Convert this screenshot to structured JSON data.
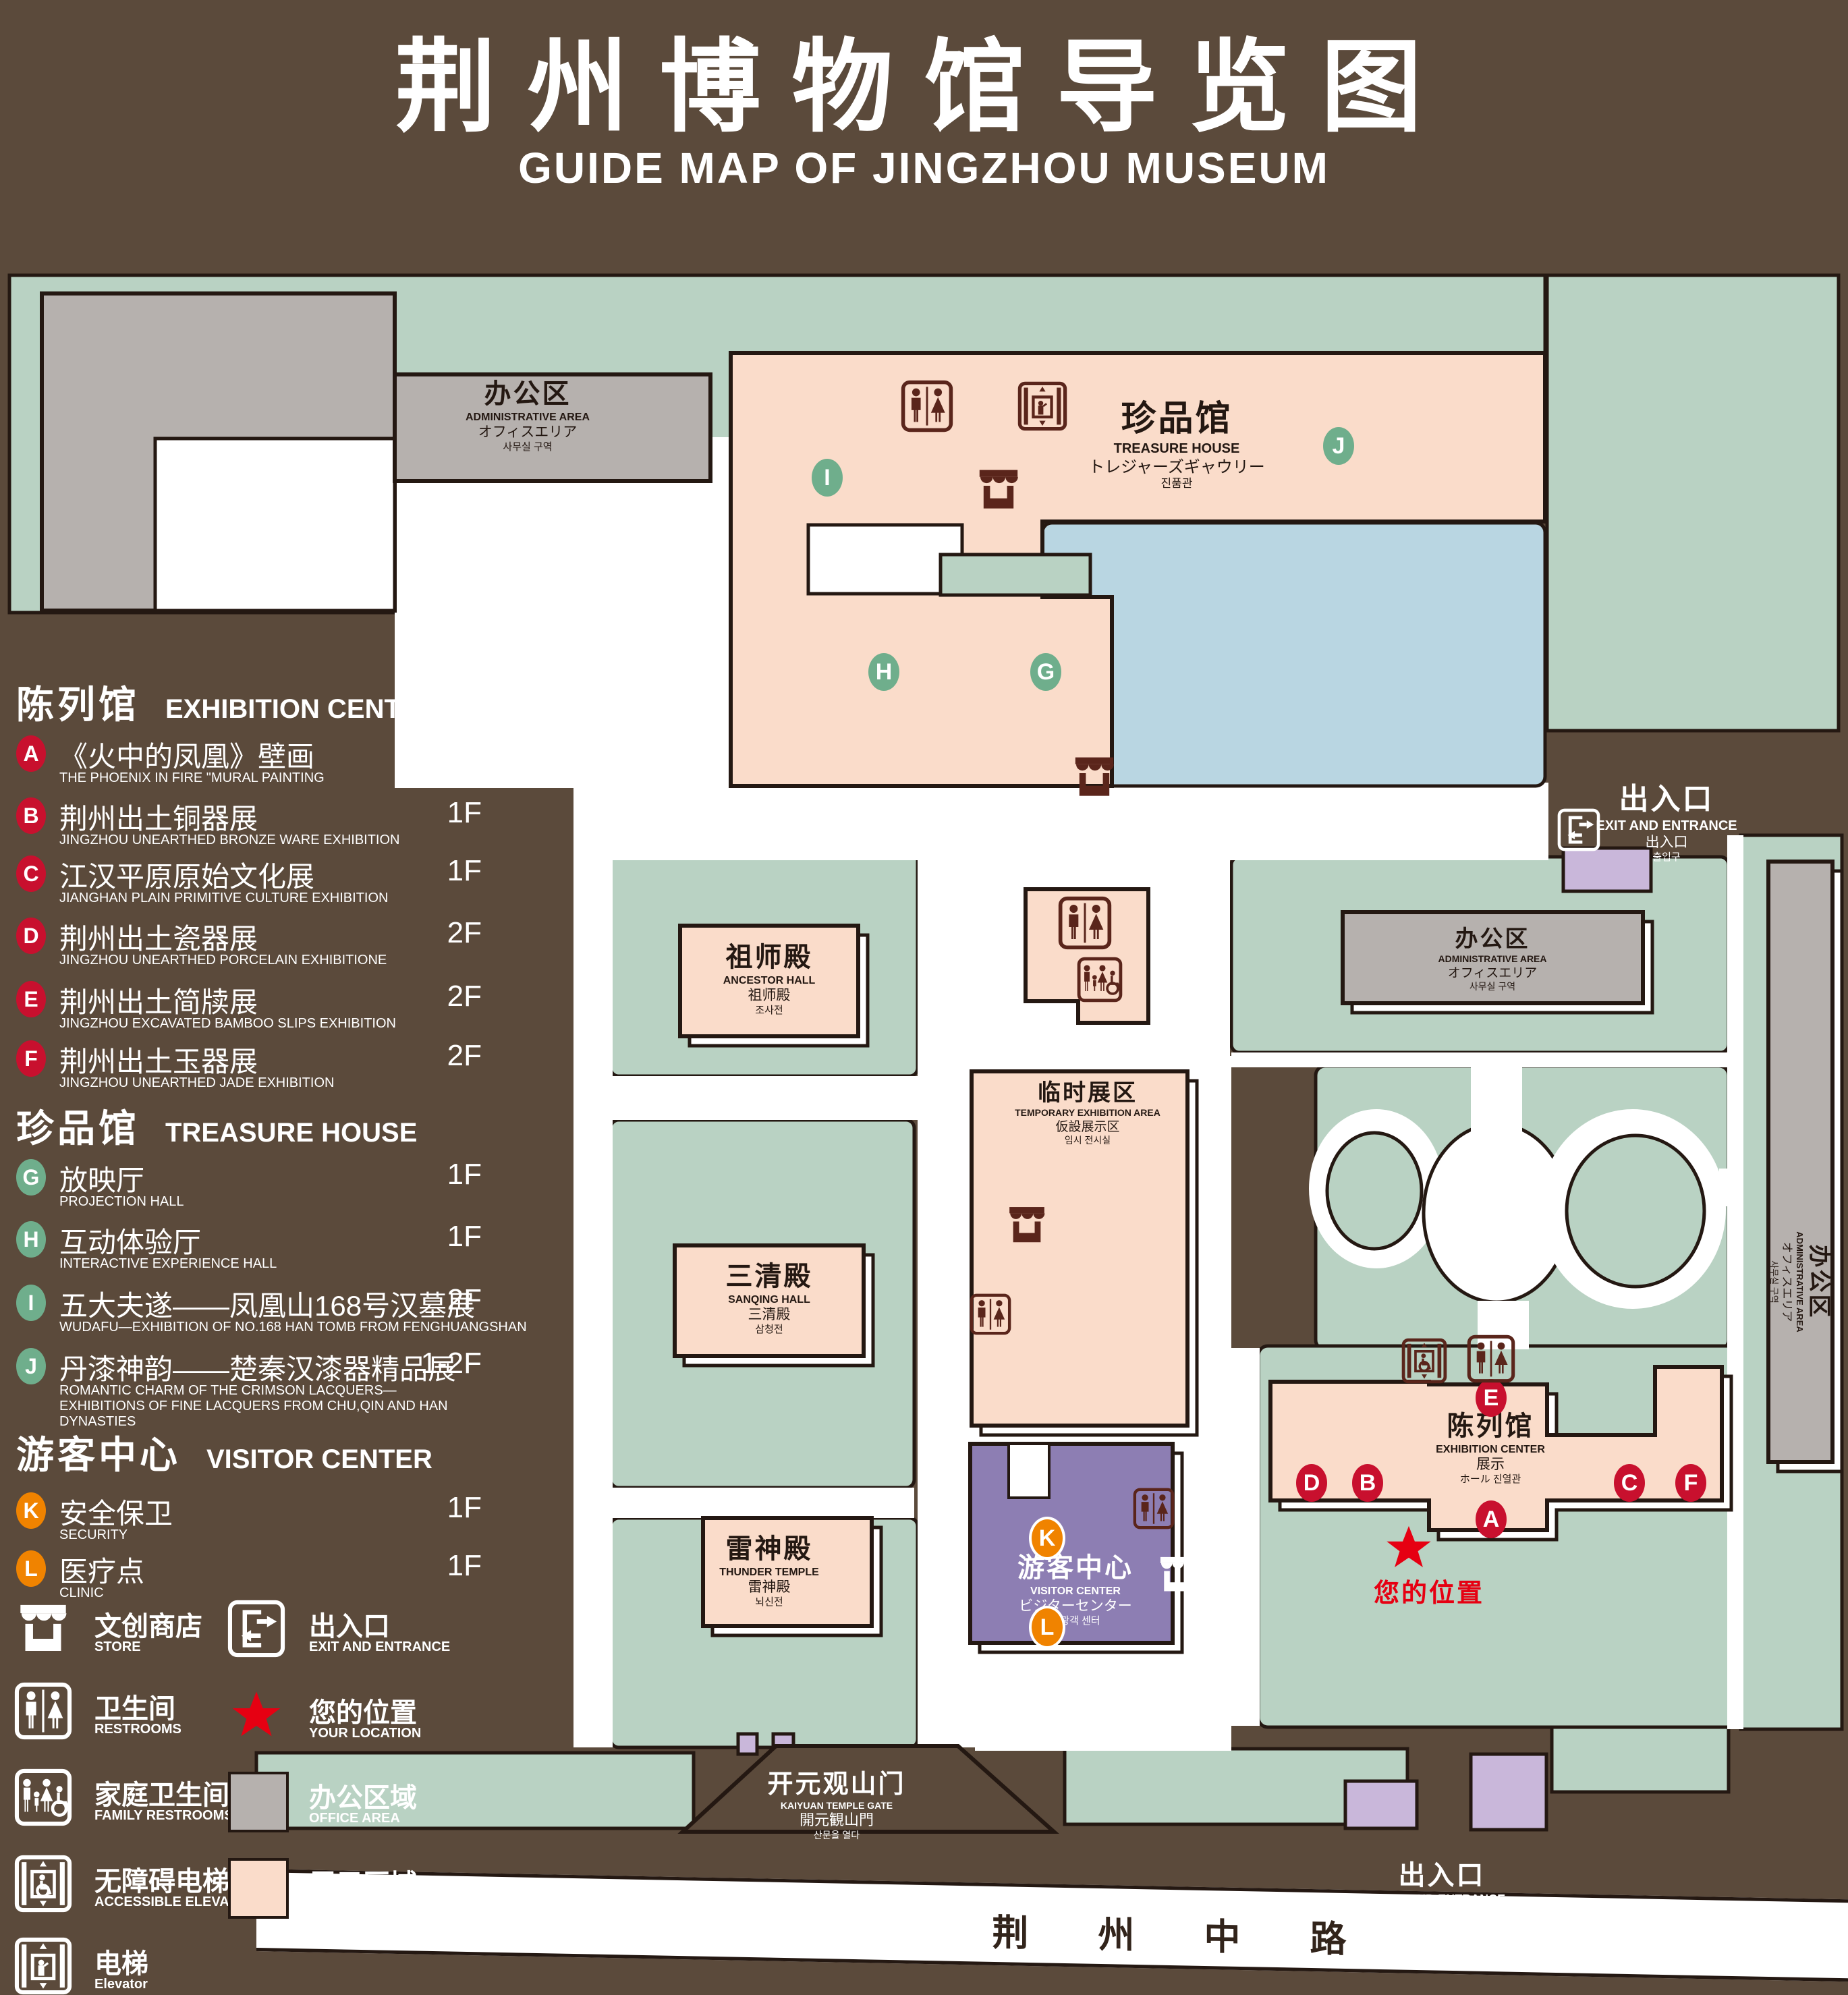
{
  "title": {
    "zh": "荆州博物馆导览图",
    "en": "GUIDE MAP OF JINGZHOU MUSEUM"
  },
  "colors": {
    "background": "#5b4a3b",
    "green": "#b9d2c3",
    "display_pink": "#fadcca",
    "office_gray": "#b6b1ae",
    "water_blue": "#b9d6e2",
    "visitor_purple": "#8d7eb3",
    "lavender": "#c9b7da",
    "outline": "#241812",
    "marker_red": "#c8102e",
    "marker_green": "#6fae8c",
    "marker_orange": "#f08300",
    "location_red": "#e60012"
  },
  "legend": {
    "sections": [
      {
        "zh": "陈列馆",
        "en": "EXHIBITION CENTER",
        "items": [
          {
            "id": "A",
            "zh": "《火中的凤凰》壁画",
            "en": "THE PHOENIX IN FIRE \"MURAL PAINTING",
            "floor": "1F"
          },
          {
            "id": "B",
            "zh": "荆州出土铜器展",
            "en": "JINGZHOU UNEARTHED BRONZE WARE EXHIBITION",
            "floor": "1F"
          },
          {
            "id": "C",
            "zh": "江汉平原原始文化展",
            "en": "JIANGHAN PLAIN PRIMITIVE CULTURE EXHIBITION",
            "floor": "1F"
          },
          {
            "id": "D",
            "zh": "荆州出土瓷器展",
            "en": "JINGZHOU UNEARTHED PORCELAIN EXHIBITIONE",
            "floor": "2F"
          },
          {
            "id": "E",
            "zh": "荆州出土简牍展",
            "en": "JINGZHOU EXCAVATED BAMBOO SLIPS EXHIBITION",
            "floor": "2F"
          },
          {
            "id": "F",
            "zh": "荆州出土玉器展",
            "en": "JINGZHOU UNEARTHED JADE EXHIBITION",
            "floor": "2F"
          }
        ]
      },
      {
        "zh": "珍品馆",
        "en": "TREASURE HOUSE",
        "items": [
          {
            "id": "G",
            "zh": "放映厅",
            "en": "PROJECTION HALL",
            "floor": "1F"
          },
          {
            "id": "H",
            "zh": "互动体验厅",
            "en": "INTERACTIVE EXPERIENCE HALL",
            "floor": "1F"
          },
          {
            "id": "I",
            "zh": "五大夫遂——凤凰山168号汉墓展",
            "en": "WUDAFU—EXHIBITION OF NO.168 HAN TOMB FROM FENGHUANGSHAN",
            "floor": "2F"
          },
          {
            "id": "J",
            "zh": "丹漆神韵——楚秦汉漆器精品展",
            "en": "ROMANTIC CHARM OF THE CRIMSON LACQUERS—EXHIBITIONS OF FINE LACQUERS FROM CHU,QIN AND HAN DYNASTIES",
            "floor": "1-2F"
          }
        ]
      },
      {
        "zh": "游客中心",
        "en": "VISITOR CENTER",
        "items": [
          {
            "id": "K",
            "zh": "安全保卫",
            "en": "SECURITY",
            "floor": "1F"
          },
          {
            "id": "L",
            "zh": "医疗点",
            "en": "CLINIC",
            "floor": "1F"
          }
        ]
      }
    ],
    "symbols": [
      {
        "icon": "store",
        "zh": "文创商店",
        "en": "STORE"
      },
      {
        "icon": "restroom",
        "zh": "卫生间",
        "en": "RESTROOMS"
      },
      {
        "icon": "family-restroom",
        "zh": "家庭卫生间",
        "en": "FAMILY RESTROOMS"
      },
      {
        "icon": "accessible-elevator",
        "zh": "无障碍电梯",
        "en": "ACCESSIBLE ELEVATOR"
      },
      {
        "icon": "elevator",
        "zh": "电梯",
        "en": "Elevator"
      },
      {
        "icon": "exit",
        "zh": "出入口",
        "en": "EXIT AND ENTRANCE"
      },
      {
        "icon": "your-location",
        "zh": "您的位置",
        "en": "YOUR LOCATION"
      },
      {
        "icon": "office-swatch",
        "zh": "办公区域",
        "en": "OFFICE AREA"
      },
      {
        "icon": "display-swatch",
        "zh": "展示区域",
        "en": "DISPLAY AREA"
      }
    ]
  },
  "map": {
    "buildings": {
      "admin": {
        "zh": "办公区",
        "en": "ADMINISTRATIVE AREA",
        "ja": "オフィスエリア",
        "ko": "사무실 구역"
      },
      "treasure": {
        "zh": "珍品馆",
        "en": "TREASURE HOUSE",
        "ja": "トレジャーズギャウリー",
        "ko": "진품관"
      },
      "ancestor": {
        "zh": "祖师殿",
        "en": "ANCESTOR HALL",
        "ja": "祖师殿",
        "ko": "조사전"
      },
      "temporary": {
        "zh": "临时展区",
        "en": "TEMPORARY EXHIBITION AREA",
        "ja": "仮設展示区",
        "ko": "임시 전시실"
      },
      "sanqing": {
        "zh": "三清殿",
        "en": "SANQING HALL",
        "ja": "三清殿",
        "ko": "삼청전"
      },
      "thunder": {
        "zh": "雷神殿",
        "en": "THUNDER TEMPLE",
        "ja": "雷神殿",
        "ko": "뇌신전"
      },
      "visitor": {
        "zh": "游客中心",
        "en": "VISITOR CENTER",
        "ja": "ビジターセンター",
        "ko": "관광객 센터"
      },
      "exhibition": {
        "zh": "陈列馆",
        "en": "EXHIBITION CENTER",
        "ja": "展示",
        "ko": "ホール 진열관"
      },
      "exit": {
        "zh": "出入口",
        "en": "EXIT AND ENTRANCE",
        "ja": "出入口",
        "ko": "출입구"
      },
      "gate": {
        "zh": "开元观山门",
        "en": "KAIYUAN TEMPLE GATE",
        "ja": "開元観山門",
        "ko": "산문을 열다"
      }
    },
    "road": "荆 州 中 路",
    "your_location": "您的位置"
  }
}
